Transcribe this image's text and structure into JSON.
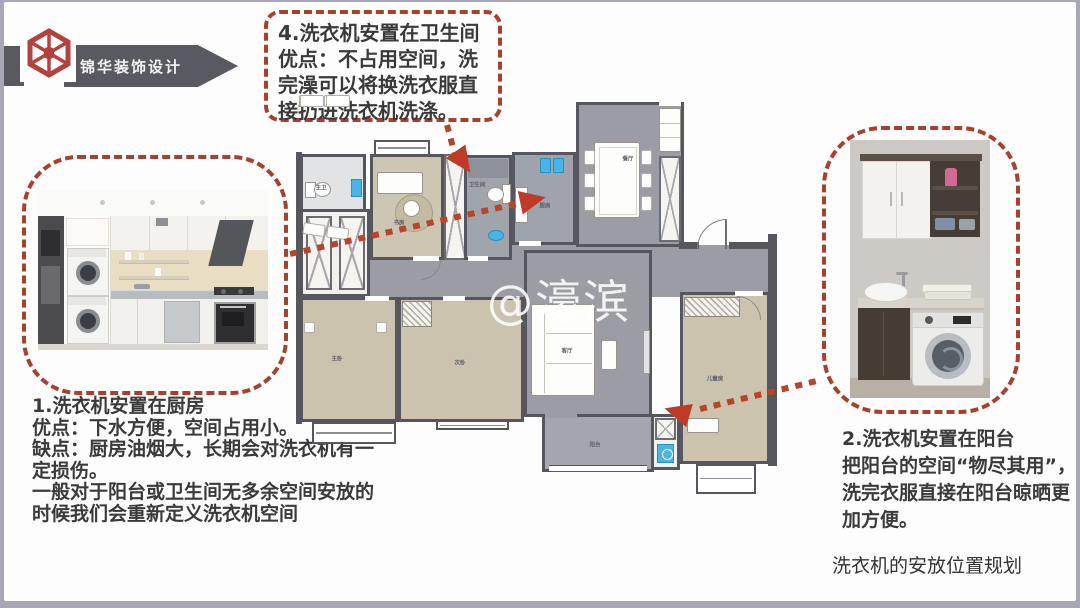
{
  "slide": {
    "watermark": "@濠滨",
    "caption": "洗衣机的安放位置规划"
  },
  "brand": {
    "name": "锦华装饰设计",
    "logo": "hex-flower-logo",
    "logo_color": "#b5413c",
    "ribbon_color": "#595961"
  },
  "callouts": {
    "c4": {
      "title": "4.洗衣机安置在卫生间",
      "body": "优点：不占用空间，洗完澡可以将换洗衣服直接扔进洗衣机洗涤。"
    },
    "c1": {
      "title": "1.洗衣机安置在厨房",
      "line1": "优点：下水方便，空间占用小。",
      "line2": "缺点：厨房油烟大，长期会对洗衣机有一定损伤。",
      "line3": "一般对于阳台或卫生间无多余空间安放的时候我们会重新定义洗衣机空间"
    },
    "c2": {
      "title": "2.洗衣机安置在阳台",
      "body": "把阳台的空间“物尽其用”，洗完衣服直接在阳台晾晒更加方便。"
    }
  },
  "floorplan": {
    "rooms": [
      {
        "label": "主卫"
      },
      {
        "label": "书房"
      },
      {
        "label": "卫生间"
      },
      {
        "label": "厨房"
      },
      {
        "label": "餐厅"
      },
      {
        "label": "主卧"
      },
      {
        "label": "次卧"
      },
      {
        "label": "客厅"
      },
      {
        "label": "阳台"
      },
      {
        "label": "儿童房"
      }
    ]
  },
  "colors": {
    "accent_red_dash": "#a8402e",
    "arrow_red": "#bf3b28",
    "wall": "#55565e",
    "floor_gray": "#9b9ca4",
    "floor_beige": "#ccc4b0",
    "appliance_blue": "#49b5e7",
    "ribbon_gray": "#595961"
  }
}
